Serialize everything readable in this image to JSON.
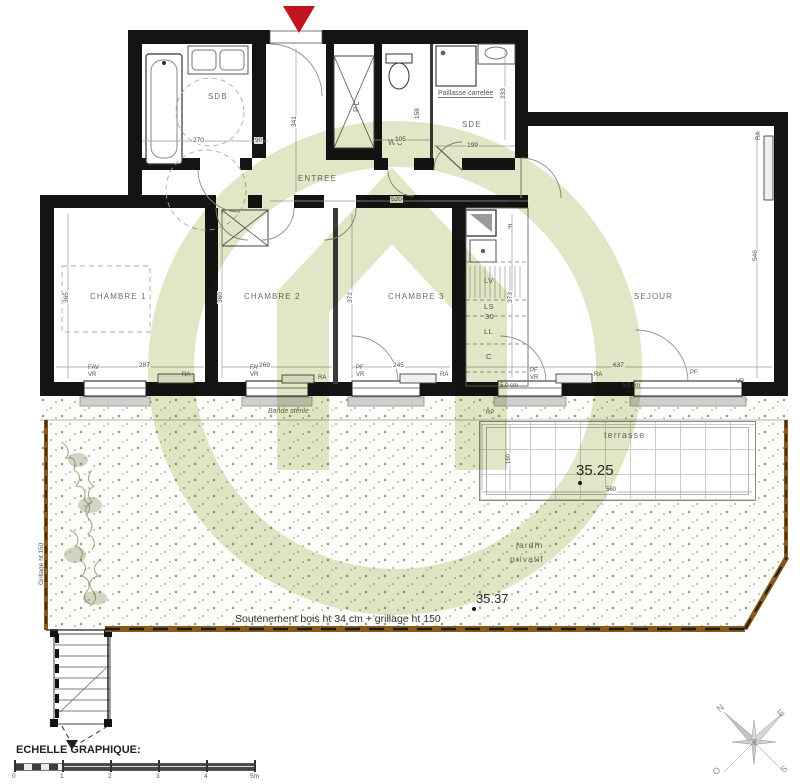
{
  "rooms": {
    "sdb": "SDB",
    "wc": "WC",
    "sde": "SDE",
    "entree": "ENTREE",
    "pl": "PL",
    "ch1": "CHAMBRE 1",
    "ch2": "CHAMBRE 2",
    "ch3": "CHAMBRE 3",
    "sejour": "SEJOUR",
    "terrasse": "terrasse",
    "jardin_line1": "jardin",
    "jardin_line2": "privatif"
  },
  "kitchen": {
    "f": "F",
    "lv": "LV",
    "ls": "LS",
    "n30": "30",
    "ll": "LL",
    "c": "C"
  },
  "notes": {
    "paillasse": "Paillasse carrelée",
    "bande_sterile": "Bande stérile",
    "soutenement": "Soutenement bois ht 34 cm + grillage ht 150",
    "grillage_left": "Grillage ht 150",
    "rp": "RP",
    "seuil": "5.0 cm"
  },
  "levels": {
    "terrasse": "35.25",
    "jardin": "35.37"
  },
  "openings": {
    "fav": "FAV",
    "vr": "VR",
    "pf": "PF",
    "ra": "RA"
  },
  "dims": {
    "sdb_w": "270",
    "sdb_w2": "90",
    "wc_w": "105",
    "wc_h": "158",
    "sde_w": "199",
    "sde_h": "233",
    "entree_h": "341",
    "entree_w": "520",
    "ch1_h": "365",
    "ch1_w": "287",
    "ch2_h": "360",
    "ch2_w": "269",
    "ch3_h": "372",
    "ch3_w": "245",
    "cuisine_h": "373",
    "sejour_h": "546",
    "sejour_w": "637",
    "terrasse_w": "560",
    "terrasse_h": "160"
  },
  "scalebar": {
    "title": "ECHELLE GRAPHIQUE:",
    "ticks": [
      "0",
      "1",
      "2",
      "3",
      "4",
      "5m"
    ]
  },
  "compass": {
    "n": "N",
    "e": "E",
    "s": "S",
    "o": "O"
  },
  "colors": {
    "wall": "#141414",
    "watermark_olive": "#e2e6c6",
    "marker_red": "#c2151e",
    "retaining_brown": "#8a5a1c",
    "gravel_dot": "#5a5a3a"
  }
}
